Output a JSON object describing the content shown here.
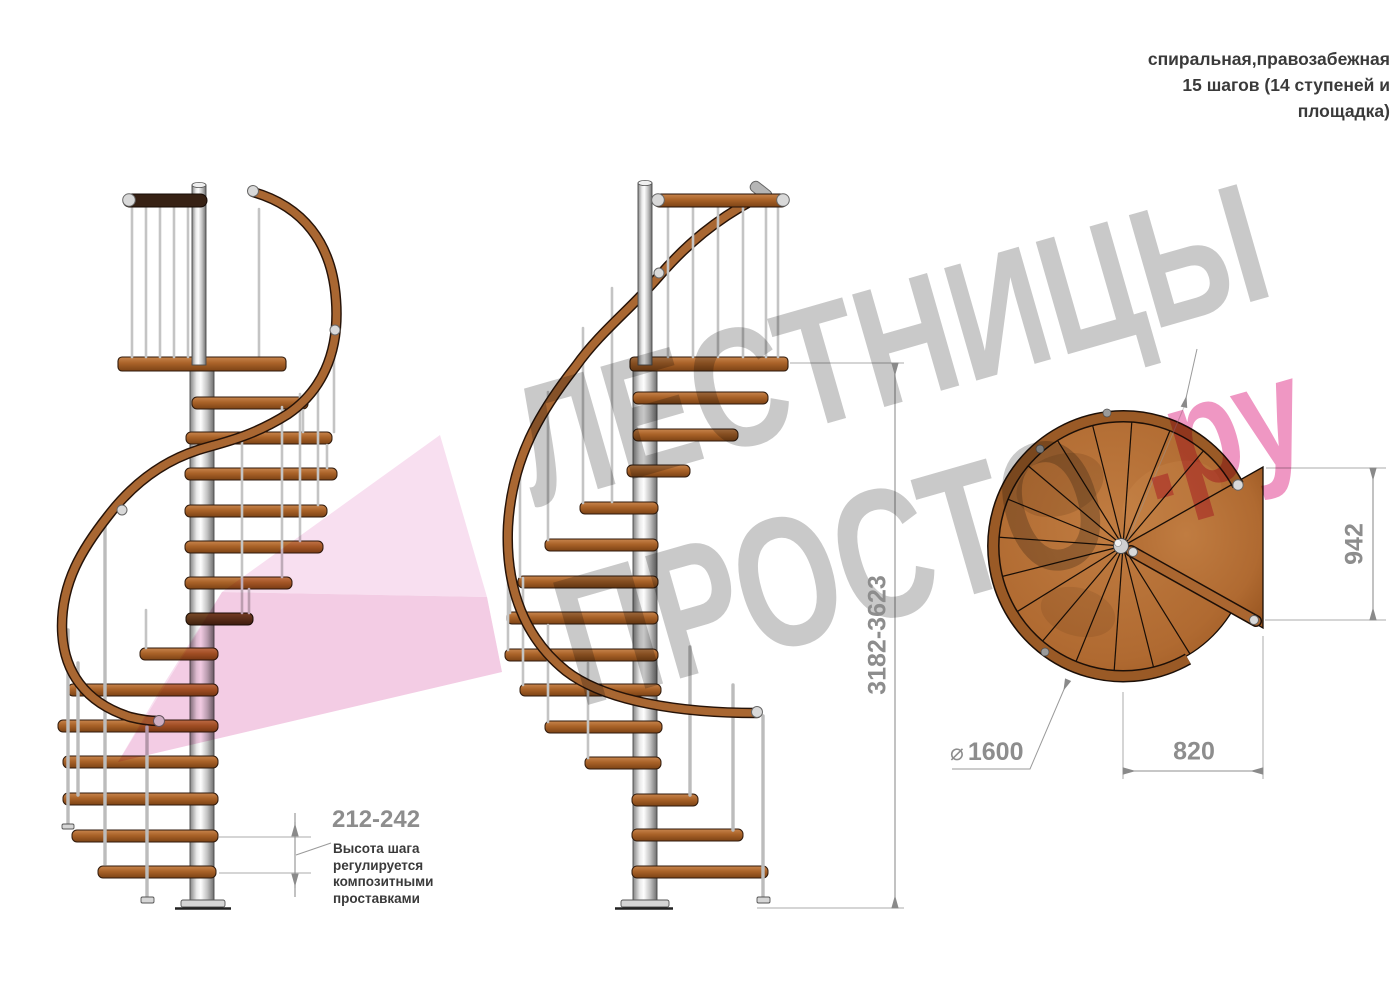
{
  "title_block": {
    "lines": [
      "спиральная,правозабежная",
      "15 шагов (14 ступеней и",
      "площадка)"
    ]
  },
  "watermark": {
    "word1": "ЛЕСТНИЦЫ",
    "word2": "ПРОСТО",
    "accent": ".ру"
  },
  "dimensions": {
    "total_height": "3182-3623",
    "landing_depth": "942",
    "center_to_edge": "820",
    "diameter_symbol": "⌀",
    "diameter": "1600",
    "step_height": "212-242",
    "step_height_note": [
      "Высота шага",
      "регулируется",
      "композитными",
      "проставками"
    ]
  },
  "colors": {
    "label_gray": "#8d8d8d",
    "text_dark": "#3a3a3a",
    "dim_line": "#9a9a9a",
    "wm_gray": "#c9c9c9",
    "wm_pink": "#ef97c3",
    "ribbon_light": "#f8dff0",
    "ribbon_deep": "#f3cce4",
    "wood_light": "#c8854d",
    "wood_mid": "#a96732",
    "wood_dark": "#7c4315",
    "rail_dark": "#372114",
    "metal_light": "#e9e9e9"
  }
}
